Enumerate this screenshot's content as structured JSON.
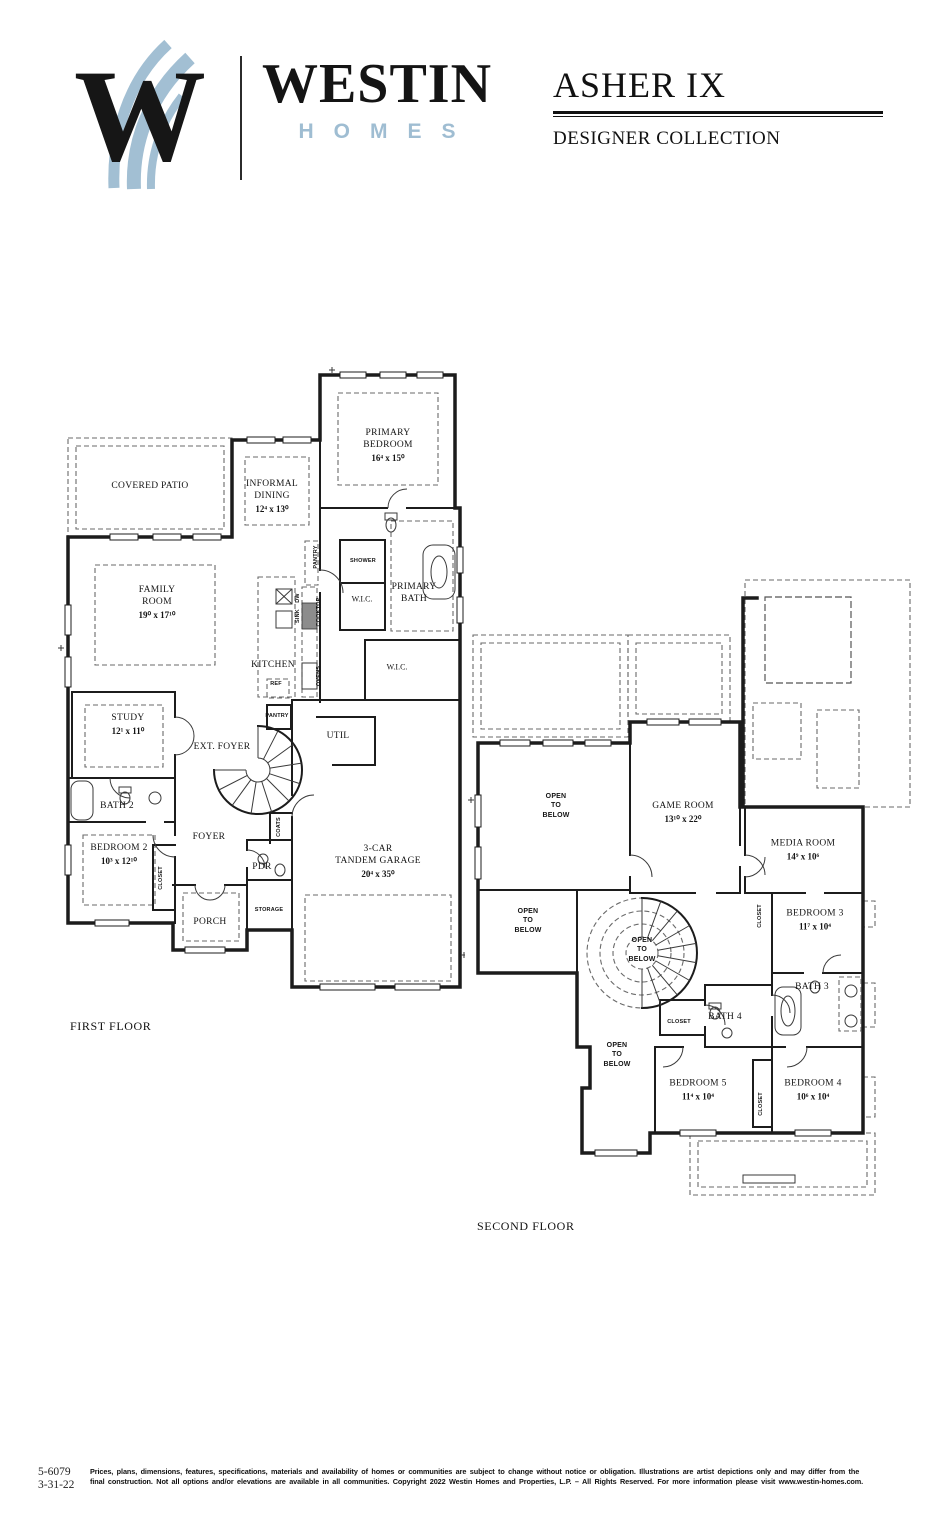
{
  "header": {
    "logo_monogram": "W",
    "brand_name": "WESTIN",
    "brand_sub": "HOMES",
    "plan_name": "ASHER IX",
    "collection": "DESIGNER COLLECTION",
    "colors": {
      "accent_blue": "#9fbdd2",
      "ink": "#141414"
    }
  },
  "floorplans": {
    "first": {
      "caption": "FIRST FLOOR",
      "labels": [
        {
          "id": "covered-patio",
          "name": "COVERED PATIO",
          "dims": ""
        },
        {
          "id": "informal-dining",
          "name": "INFORMAL\nDINING",
          "dims": "12⁴ x 13⁰"
        },
        {
          "id": "primary-bedroom",
          "name": "PRIMARY\nBEDROOM",
          "dims": "16⁴ x 15⁰"
        },
        {
          "id": "family-room",
          "name": "FAMILY\nROOM",
          "dims": "19⁰ x 17¹⁰"
        },
        {
          "id": "kitchen",
          "name": "KITCHEN",
          "dims": ""
        },
        {
          "id": "shower",
          "name": "SHOWER",
          "dims": ""
        },
        {
          "id": "wic-1",
          "name": "W.I.C.",
          "dims": ""
        },
        {
          "id": "primary-bath",
          "name": "PRIMARY\nBATH",
          "dims": ""
        },
        {
          "id": "wic-2",
          "name": "W.I.C.",
          "dims": ""
        },
        {
          "id": "pantry-1",
          "name": "PANTRY",
          "dims": ""
        },
        {
          "id": "cooktop",
          "name": "COOKTOP",
          "dims": ""
        },
        {
          "id": "ovens",
          "name": "OVENS",
          "dims": ""
        },
        {
          "id": "dw",
          "name": "DW",
          "dims": ""
        },
        {
          "id": "sink",
          "name": "SINK",
          "dims": ""
        },
        {
          "id": "ref",
          "name": "REF",
          "dims": ""
        },
        {
          "id": "study",
          "name": "STUDY",
          "dims": "12¹ x 11⁰"
        },
        {
          "id": "ext-foyer",
          "name": "EXT. FOYER",
          "dims": ""
        },
        {
          "id": "pantry-2",
          "name": "PANTRY",
          "dims": ""
        },
        {
          "id": "util",
          "name": "UTIL",
          "dims": ""
        },
        {
          "id": "bath-2",
          "name": "BATH 2",
          "dims": ""
        },
        {
          "id": "bedroom-2",
          "name": "BEDROOM 2",
          "dims": "10³ x 12¹⁰"
        },
        {
          "id": "foyer",
          "name": "FOYER",
          "dims": ""
        },
        {
          "id": "closet-1",
          "name": "CLOSET",
          "dims": ""
        },
        {
          "id": "coats",
          "name": "COATS",
          "dims": ""
        },
        {
          "id": "pdr",
          "name": "PDR",
          "dims": ""
        },
        {
          "id": "porch",
          "name": "PORCH",
          "dims": ""
        },
        {
          "id": "storage",
          "name": "STORAGE",
          "dims": ""
        },
        {
          "id": "garage",
          "name": "3-CAR\nTANDEM GARAGE",
          "dims": "20⁴ x 35⁰"
        }
      ]
    },
    "second": {
      "caption": "SECOND FLOOR",
      "labels": [
        {
          "id": "open-below-1",
          "name": "OPEN\nTO\nBELOW",
          "dims": ""
        },
        {
          "id": "game-room",
          "name": "GAME ROOM",
          "dims": "13¹⁰ x 22⁰"
        },
        {
          "id": "media-room",
          "name": "MEDIA ROOM",
          "dims": "14⁹ x 10⁶"
        },
        {
          "id": "open-below-2",
          "name": "OPEN\nTO\nBELOW",
          "dims": ""
        },
        {
          "id": "open-below-3",
          "name": "OPEN\nTO\nBELOW",
          "dims": ""
        },
        {
          "id": "bedroom-3",
          "name": "BEDROOM 3",
          "dims": "11⁷ x 10⁴"
        },
        {
          "id": "closet-2",
          "name": "CLOSET",
          "dims": ""
        },
        {
          "id": "bath-3",
          "name": "BATH 3",
          "dims": ""
        },
        {
          "id": "bath-4",
          "name": "BATH 4",
          "dims": ""
        },
        {
          "id": "closet-3",
          "name": "CLOSET",
          "dims": ""
        },
        {
          "id": "open-below-4",
          "name": "OPEN\nTO\nBELOW",
          "dims": ""
        },
        {
          "id": "bedroom-5",
          "name": "BEDROOM 5",
          "dims": "11⁴ x 10⁴"
        },
        {
          "id": "closet-4",
          "name": "CLOSET",
          "dims": ""
        },
        {
          "id": "bedroom-4",
          "name": "BEDROOM 4",
          "dims": "10⁶ x 10⁴"
        }
      ]
    }
  },
  "footer": {
    "plan_number": "5-6079",
    "date": "3-31-22",
    "disclaimer_line1": "Prices, plans, dimensions, features, specifications, materials and availability of homes or communities are subject to change without notice or obligation.  Illustrations are artist depictions only and may differ from the",
    "disclaimer_line2": "final construction.  Not all options and/or elevations are available in all communities.  Copyright 2022 Westin Homes and Properties, L.P. – All Rights Reserved.  For more information please visit www.westin-homes.com."
  }
}
